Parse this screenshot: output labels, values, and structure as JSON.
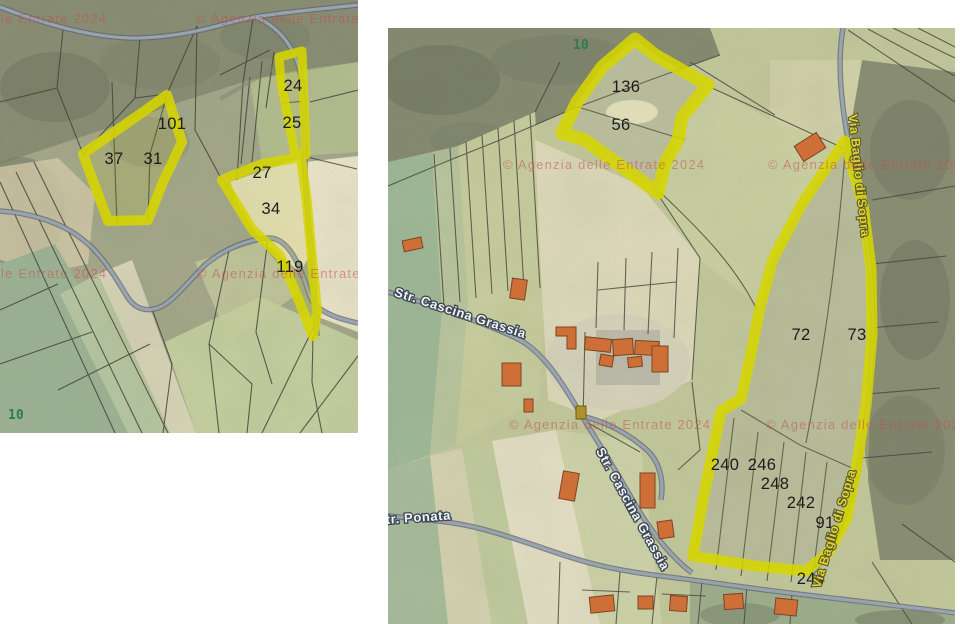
{
  "page": {
    "background": "#ffffff",
    "description": "Two cadastral map extracts with highlighted parcels"
  },
  "watermark_text": "© Agenzia delle Entrate 2024",
  "colors": {
    "highlight_yellow": "#d6d600",
    "watermark_red": "#c2504e",
    "sheet_green": "#2e7b4e",
    "parcel_number_black": "#1c1c1c",
    "street_label_white": "#f2f4f6",
    "street_label_yellow": "#e3d52f",
    "building_orange": "#cf6f38",
    "road_gray": "#9aa6b2"
  },
  "maps": {
    "left": {
      "name": "cadastral-map-left",
      "sheet_number": "10",
      "highlighted_parcel_numbers": [
        "101",
        "37",
        "31",
        "24",
        "25",
        "27",
        "34",
        "119"
      ],
      "labels": [
        {
          "name": "parcel-number-101",
          "cls": "parcel-number",
          "text": "101",
          "x": 172,
          "y": 217
        },
        {
          "name": "parcel-number-37",
          "cls": "parcel-number",
          "text": "37",
          "x": 114,
          "y": 252
        },
        {
          "name": "parcel-number-31",
          "cls": "parcel-number",
          "text": "31",
          "x": 153,
          "y": 252
        },
        {
          "name": "parcel-number-24",
          "cls": "parcel-number",
          "text": "24",
          "x": 293,
          "y": 179
        },
        {
          "name": "parcel-number-25",
          "cls": "parcel-number",
          "text": "25",
          "x": 292,
          "y": 216
        },
        {
          "name": "parcel-number-27",
          "cls": "parcel-number",
          "text": "27",
          "x": 262,
          "y": 266
        },
        {
          "name": "parcel-number-34",
          "cls": "parcel-number",
          "text": "34",
          "x": 271,
          "y": 302
        },
        {
          "name": "parcel-number-119",
          "cls": "parcel-number",
          "text": "119",
          "x": 290,
          "y": 360
        },
        {
          "name": "sheet-number",
          "cls": "sheet-number",
          "text": "10",
          "x": 8,
          "y": 507,
          "anchor": "start"
        },
        {
          "name": "watermark",
          "cls": "watermark",
          "text": "© Agenzia delle Entrate 2024",
          "x": -95,
          "y": 111,
          "anchor": "start"
        },
        {
          "name": "watermark",
          "cls": "watermark",
          "text": "© Agenzia delle Entrate 2024",
          "x": 196,
          "y": 111,
          "anchor": "start"
        },
        {
          "name": "watermark",
          "cls": "watermark",
          "text": "© Agenzia delle Entrate 2024",
          "x": -95,
          "y": 366,
          "anchor": "start"
        },
        {
          "name": "watermark",
          "cls": "watermark",
          "text": "© Agenzia delle Entrate 2024",
          "x": 197,
          "y": 366,
          "anchor": "start"
        }
      ]
    },
    "right": {
      "name": "cadastral-map-right",
      "sheet_number": "10",
      "highlighted_parcel_numbers": [
        "136",
        "56",
        "72",
        "73",
        "240",
        "246",
        "248",
        "242",
        "91",
        "244"
      ],
      "street_names": [
        "Str. Cascina Grassia",
        "Str. Ponata",
        "Via Baglio di Sopra"
      ],
      "labels": [
        {
          "name": "sheet-number",
          "cls": "sheet-number",
          "text": "10",
          "x": 573,
          "y": 49,
          "anchor": "start"
        },
        {
          "name": "parcel-number-136",
          "cls": "parcel-number",
          "text": "136",
          "x": 626,
          "y": 92
        },
        {
          "name": "parcel-number-56",
          "cls": "parcel-number",
          "text": "56",
          "x": 621,
          "y": 130
        },
        {
          "name": "parcel-number-72",
          "cls": "parcel-number",
          "text": "72",
          "x": 801,
          "y": 340
        },
        {
          "name": "parcel-number-73",
          "cls": "parcel-number",
          "text": "73",
          "x": 857,
          "y": 340
        },
        {
          "name": "parcel-number-240",
          "cls": "parcel-number",
          "text": "240",
          "x": 725,
          "y": 470
        },
        {
          "name": "parcel-number-246",
          "cls": "parcel-number",
          "text": "246",
          "x": 762,
          "y": 470
        },
        {
          "name": "parcel-number-248",
          "cls": "parcel-number",
          "text": "248",
          "x": 775,
          "y": 489
        },
        {
          "name": "parcel-number-242",
          "cls": "parcel-number",
          "text": "242",
          "x": 801,
          "y": 508
        },
        {
          "name": "parcel-number-91",
          "cls": "parcel-number",
          "text": "91",
          "x": 825,
          "y": 528
        },
        {
          "name": "parcel-number-244",
          "cls": "parcel-number",
          "text": "244",
          "x": 811,
          "y": 584
        },
        {
          "name": "street-label-str-cascina-grassia-1",
          "cls": "street-white",
          "text": "Str. Cascina Grassia",
          "x": 459,
          "y": 317,
          "rotate": 18
        },
        {
          "name": "street-label-str-ponata",
          "cls": "street-white",
          "text": "Str. Ponata",
          "x": 414,
          "y": 522,
          "rotate": -4
        },
        {
          "name": "street-label-str-cascina-grassia-2",
          "cls": "street-white",
          "text": "Str. Cascina Grassia",
          "x": 629,
          "y": 511,
          "rotate": 61
        },
        {
          "name": "street-label-via-baglio-di-sopra-1",
          "cls": "street-yellow",
          "text": "Via Baglio di Sopra",
          "x": 855,
          "y": 176,
          "rotate": 84
        },
        {
          "name": "street-label-via-baglio-di-sopra-2",
          "cls": "street-yellow",
          "text": "Via Baglio di Sopra",
          "x": 838,
          "y": 530,
          "rotate": -73
        },
        {
          "name": "watermark",
          "cls": "watermark",
          "text": "© Agenzia delle Entrate 2024",
          "x": 503,
          "y": 169,
          "anchor": "start"
        },
        {
          "name": "watermark",
          "cls": "watermark",
          "text": "© Agenzia delle Entrate 2024",
          "x": 768,
          "y": 169,
          "anchor": "start"
        },
        {
          "name": "watermark",
          "cls": "watermark",
          "text": "© Agenzia delle Entrate 2024",
          "x": 509,
          "y": 429,
          "anchor": "start"
        },
        {
          "name": "watermark",
          "cls": "watermark",
          "text": "© Agenzia delle Entrate 2024",
          "x": 766,
          "y": 429,
          "anchor": "start"
        }
      ]
    }
  }
}
